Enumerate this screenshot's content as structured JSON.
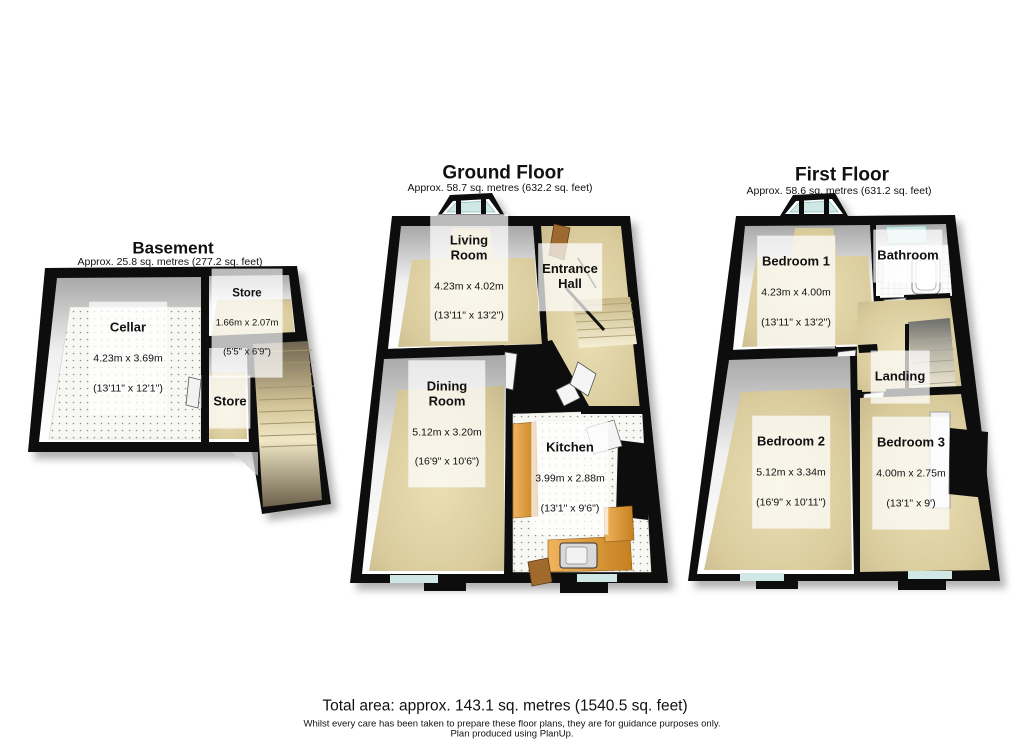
{
  "basement": {
    "title": "Basement",
    "area": "Approx. 25.8 sq. metres (277.2 sq. feet)",
    "cellar": {
      "name": "Cellar",
      "dims_m": "4.23m x 3.69m",
      "dims_ft": "(13'11\" x 12'1\")"
    },
    "store_upper": {
      "name": "Store",
      "dims_m": "1.66m x 2.07m",
      "dims_ft": "(5'5\" x 6'9\")"
    },
    "store_lower": {
      "name": "Store"
    }
  },
  "ground_floor": {
    "title": "Ground Floor",
    "area": "Approx. 58.7 sq. metres (632.2 sq. feet)",
    "living_room": {
      "name": "Living\nRoom",
      "dims_m": "4.23m x 4.02m",
      "dims_ft": "(13'11\" x 13'2\")"
    },
    "entrance_hall": {
      "name": "Entrance\nHall"
    },
    "dining_room": {
      "name": "Dining\nRoom",
      "dims_m": "5.12m x 3.20m",
      "dims_ft": "(16'9\" x 10'6\")"
    },
    "kitchen": {
      "name": "Kitchen",
      "dims_m": "3.99m x 2.88m",
      "dims_ft": "(13'1\" x 9'6\")"
    }
  },
  "first_floor": {
    "title": "First Floor",
    "area": "Approx. 58.6 sq. metres (631.2 sq. feet)",
    "bedroom1": {
      "name": "Bedroom 1",
      "dims_m": "4.23m x 4.00m",
      "dims_ft": "(13'11\" x 13'2\")"
    },
    "bathroom": {
      "name": "Bathroom"
    },
    "landing": {
      "name": "Landing"
    },
    "bedroom2": {
      "name": "Bedroom 2",
      "dims_m": "5.12m x 3.34m",
      "dims_ft": "(16'9\" x 10'11\")"
    },
    "bedroom3": {
      "name": "Bedroom 3",
      "dims_m": "4.00m x 2.75m",
      "dims_ft": "(13'1\" x 9')"
    }
  },
  "footer": {
    "total_area": "Total area: approx. 143.1 sq. metres (1540.5 sq. feet)",
    "disclaimer": "Whilst every care has been taken to prepare these floor plans, they are for guidance purposes only.",
    "produced": "Plan produced using PlanUp."
  },
  "colors": {
    "wall": "#0d0d0d",
    "floor_beige": "#dccfa2",
    "dotted_floor": "#f7f7f4",
    "window_glass": "#cfe8e5",
    "kitchen_counter": "#d6922f",
    "wood_door": "#9c6a30"
  }
}
